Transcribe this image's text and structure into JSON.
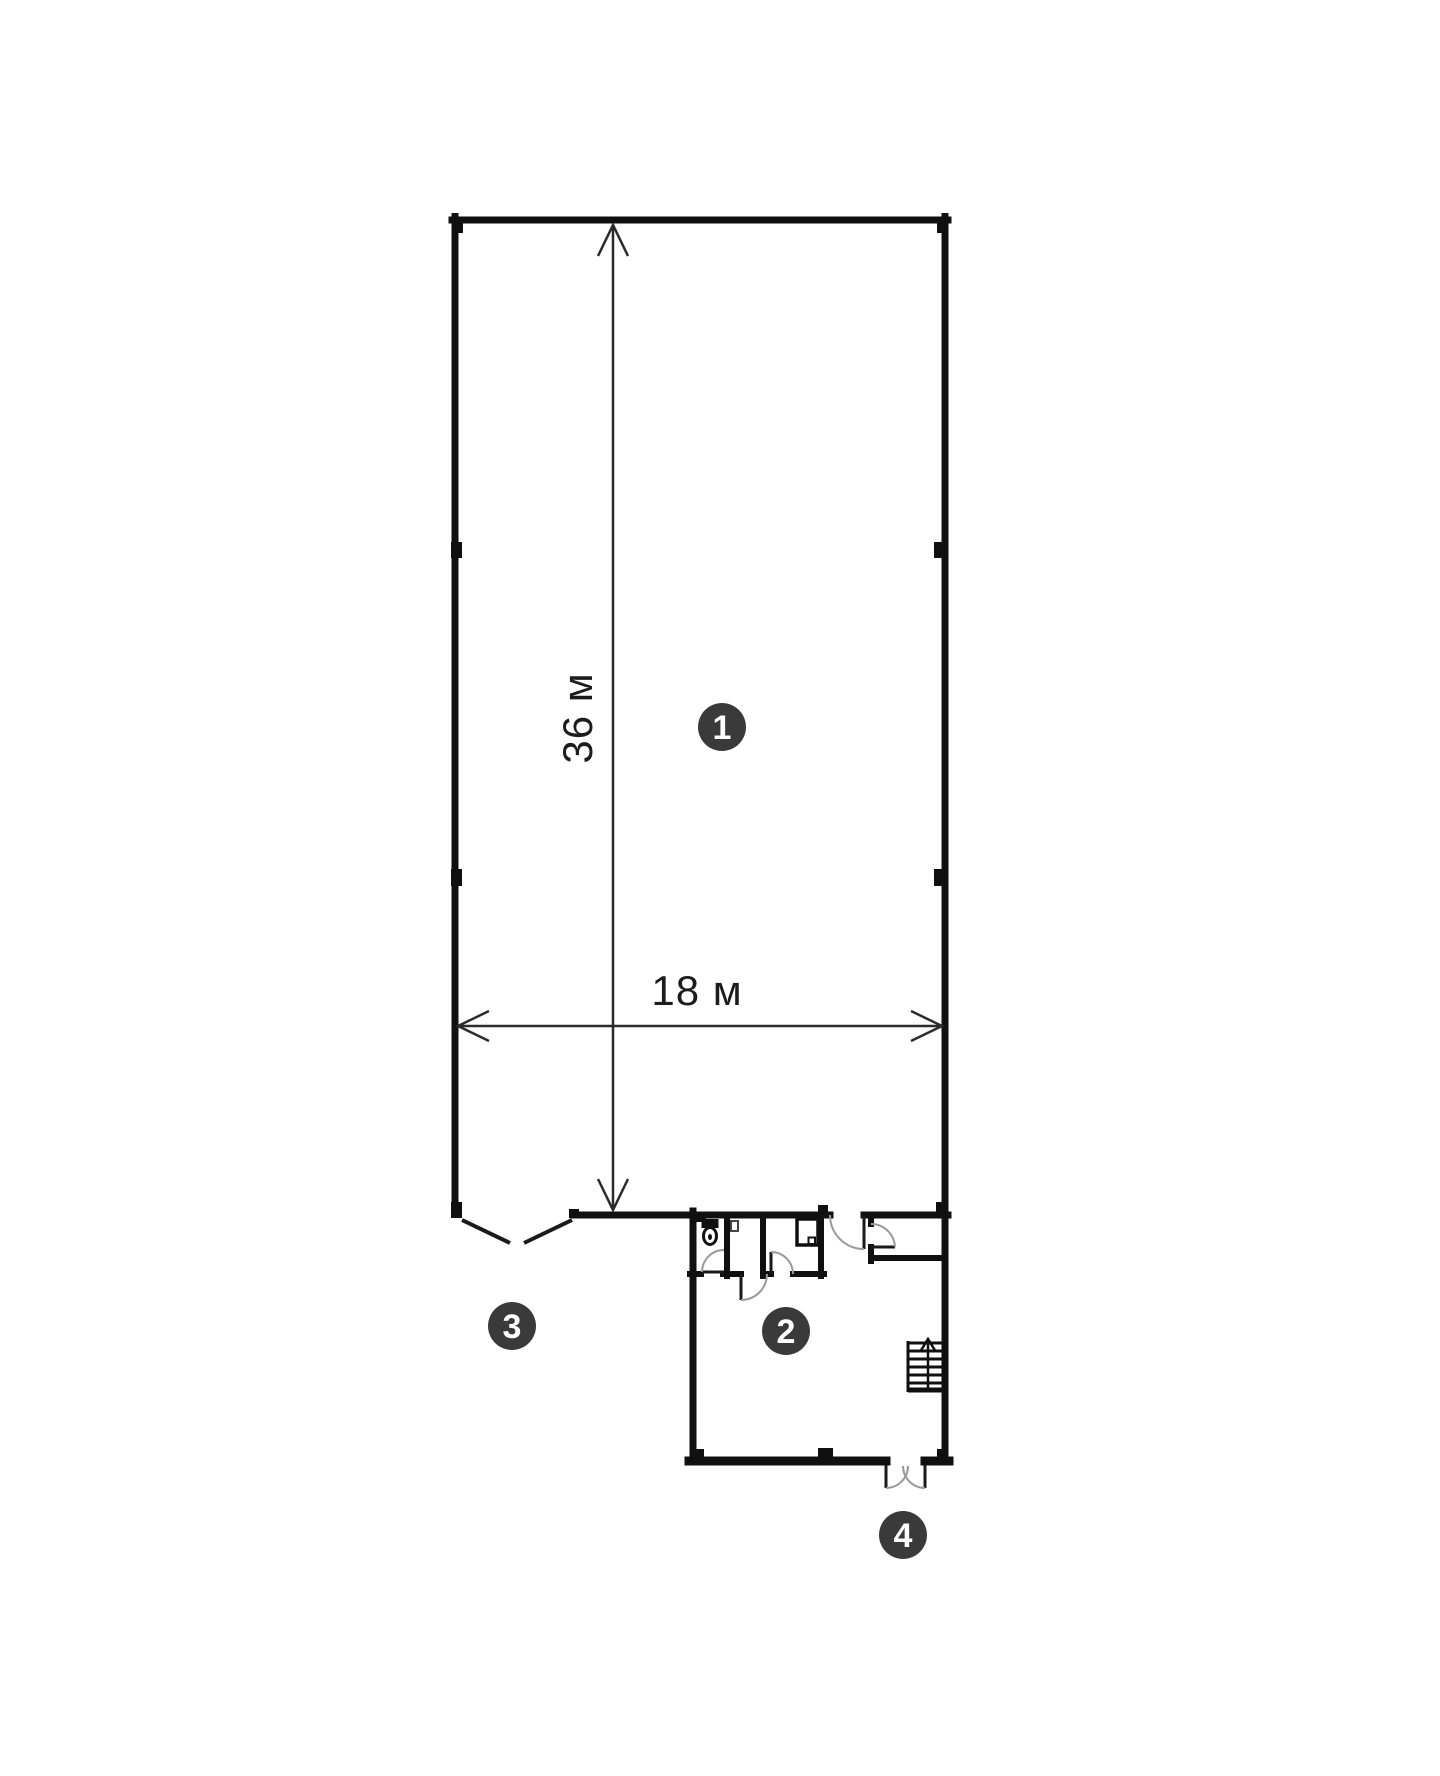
{
  "plan": {
    "background": "#ffffff",
    "wall_color": "#101010",
    "door_leaf_color": "#1a1a1a",
    "door_arc_color": "#999999",
    "dimension_color": "#2b2b2b",
    "text_color": "#1c1c1c",
    "marker_fill": "#3a3a3a",
    "marker_text_color": "#ffffff",
    "dimensions": {
      "vertical_label": "36 м",
      "horizontal_label": "18 м"
    },
    "markers": [
      {
        "label": "1"
      },
      {
        "label": "2"
      },
      {
        "label": "3"
      },
      {
        "label": "4"
      }
    ]
  }
}
